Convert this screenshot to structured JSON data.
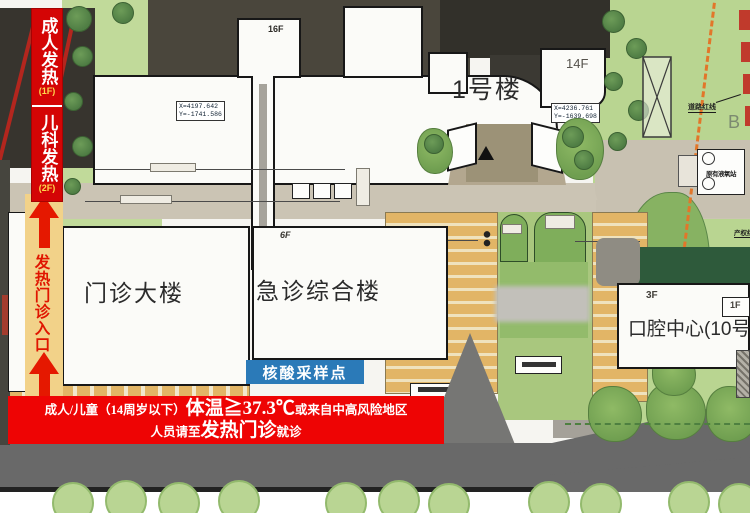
{
  "left_banner": {
    "adult_fever": "成人发热",
    "adult_fever_floor": "(1F)",
    "pediatric_fever": "儿科发热",
    "pediatric_fever_floor": "(2F)",
    "entrance": "发热门诊入口"
  },
  "buildings": {
    "building1_name": "1号楼",
    "building1_floors": "16F",
    "building1_wing_floors": "14F",
    "outpatient_name": "门诊大楼",
    "emergency_name": "急诊综合楼",
    "emergency_floors": "6F",
    "dental_name": "口腔中心(10号",
    "dental_floors": "3F",
    "dental_annex_floors": "1F",
    "oxygen_station": "原有液氧站"
  },
  "survey_marks": {
    "mark1_line1": "X=4197.642",
    "mark1_line2": "Y=-1741.586",
    "mark2_line1": "X=4236.761",
    "mark2_line2": "Y=-1639.698"
  },
  "annotations": {
    "road_red_line": "道路红线",
    "property_red_line": "产权红线",
    "zone_b": "B"
  },
  "sampling_point_label": "核酸采样点",
  "notice": {
    "line1_prefix": "成人/儿童（14周岁以下）",
    "line1_emphasis": "体温≧37.3℃",
    "line1_suffix": "或来自中高风险地区",
    "line2_prefix": "人员请至",
    "line2_emphasis": "发热门诊",
    "line2_suffix": "就诊"
  },
  "colors": {
    "fever_red": "#d40505",
    "notice_red": "#ee0404",
    "entrance_yellow": "#f2d289",
    "arrow_red": "#e51800",
    "sampling_blue": "#2b7ab8",
    "grass_green": "#bfd898",
    "tree_green": "#5d8f4e",
    "parking_stripe_yellow": "#e2b566",
    "road_dark_gray": "#696969",
    "road_beige": "#cbc4b4"
  }
}
